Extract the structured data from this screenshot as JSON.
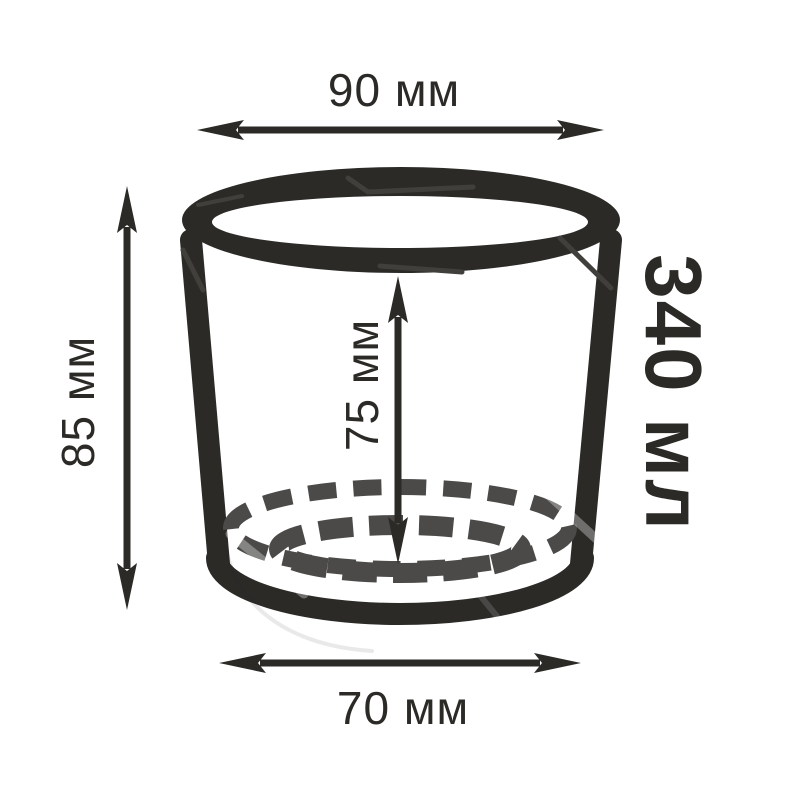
{
  "diagram": {
    "kind": "product-dimension-diagram",
    "object": "glass-cup",
    "colors": {
      "ink": "#2b2a27",
      "dash": "#4b4a48",
      "bg": "#ffffff"
    },
    "labels": {
      "top_width": {
        "text": "90 мм",
        "value": 90,
        "unit": "мм",
        "position": "top",
        "measures": "rim outer diameter"
      },
      "outer_height": {
        "text": "85 мм",
        "value": 85,
        "unit": "мм",
        "position": "left",
        "measures": "overall height"
      },
      "inner_height": {
        "text": "75 мм",
        "value": 75,
        "unit": "мм",
        "position": "center",
        "measures": "inner depth"
      },
      "bottom_width": {
        "text": "70 мм",
        "value": 70,
        "unit": "мм",
        "position": "bottom",
        "measures": "base diameter"
      },
      "volume": {
        "text": "340 мл",
        "value": 340,
        "unit": "мл",
        "position": "right",
        "measures": "capacity"
      }
    }
  }
}
